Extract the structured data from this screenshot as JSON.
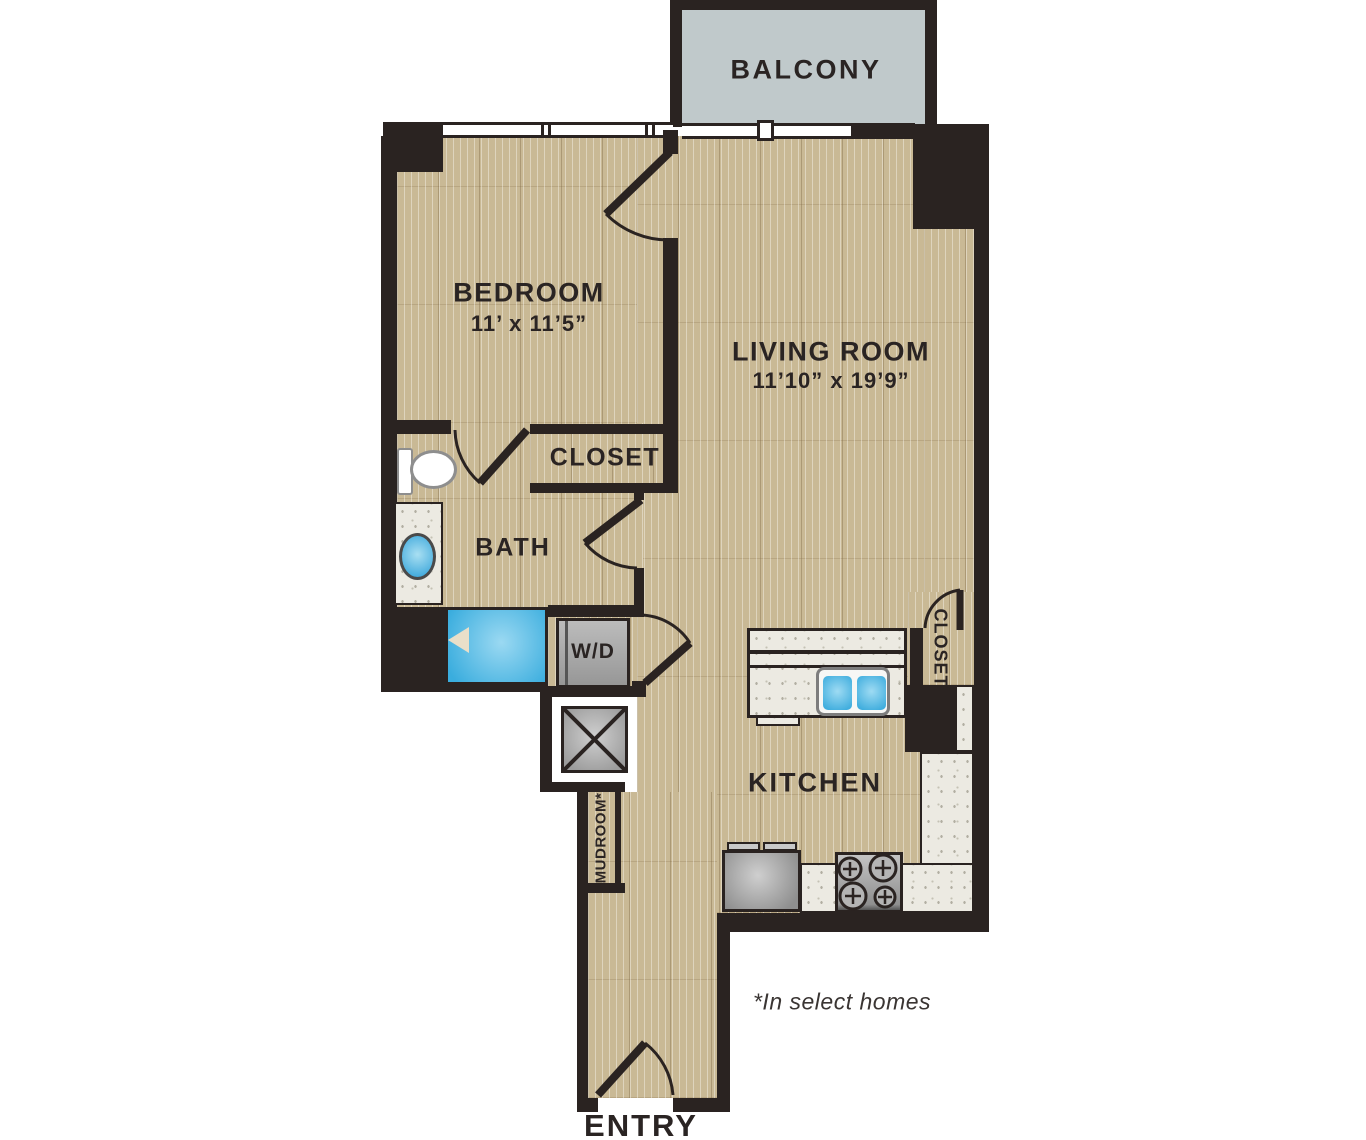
{
  "plan": {
    "balcony": {
      "label": "BALCONY"
    },
    "bedroom": {
      "label": "BEDROOM",
      "dims": "11’ x 11’5”"
    },
    "living_room": {
      "label": "LIVING ROOM",
      "dims": "11’10” x 19’9”"
    },
    "hall_closet": {
      "label": "CLOSET"
    },
    "bath": {
      "label": "BATH"
    },
    "washer_dryer": {
      "label": "W/D"
    },
    "kitchen": {
      "label": "KITCHEN"
    },
    "kitchen_closet": {
      "label": "CLOSET"
    },
    "mudroom": {
      "label": "MUDROOM*"
    },
    "entry": {
      "label": "ENTRY"
    },
    "footnote": "*In select homes"
  },
  "colors": {
    "wall": "#2a2321",
    "floor": "#c9b995",
    "balcony_deck": "#c0c9cb",
    "counter": "#eceae2",
    "appliance": "#a8a8a8",
    "water": "#45b2e3",
    "text": "#2a2423"
  }
}
